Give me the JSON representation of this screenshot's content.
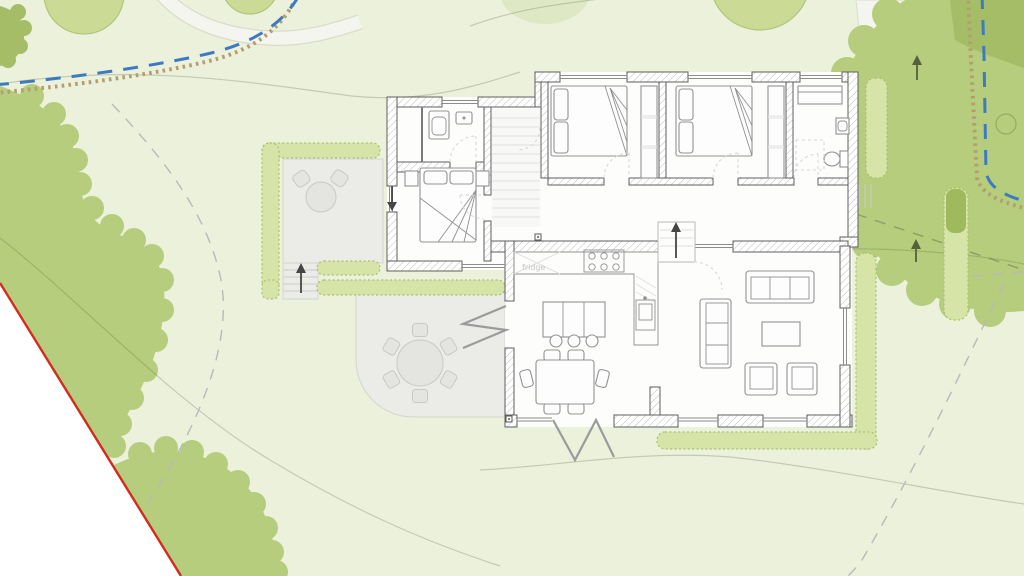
{
  "labels": {
    "fridge": "fridge"
  },
  "icons": {
    "slope_arrow": "up-arrow",
    "entry_arrow": "down-arrow"
  },
  "palette": {
    "bg": "#ecf1dc",
    "outside": "#ffffff",
    "canopy": "#b5cd7c",
    "canopy_dark": "#a6bd68",
    "tree_light": "#cbdb96",
    "tree_light_stroke": "#b1c57c",
    "tree_faint": "#dfe8c5",
    "hedge": "#d7e4a8",
    "hedge_stroke": "#a9bf70",
    "hedge_dark": "#9eba5c",
    "path_fill": "#f5f5f0",
    "path_edge": "#dadcc9",
    "stipple": "#b49d6f",
    "water": "#3d7ac0",
    "boundary": "#d22b20",
    "paving": "#ebebe7",
    "paving_edge": "#d5d5cf",
    "room_fill": "#fdfdfc",
    "wall_stroke": "#5f5f5f",
    "hatchline": "#bcbcbc",
    "glass": "#8c8c8c",
    "furn_stroke": "#929292",
    "furn_fill": "#fdfdfd",
    "door_arc": "#d8d8d8",
    "dash": "#b9b9b9",
    "text_gray": "#c4c4c4",
    "arrow_dark": "#454545",
    "arrow_olive": "#55613c",
    "table_fill": "#e4e4e0",
    "steps": "#cbcbcb"
  }
}
